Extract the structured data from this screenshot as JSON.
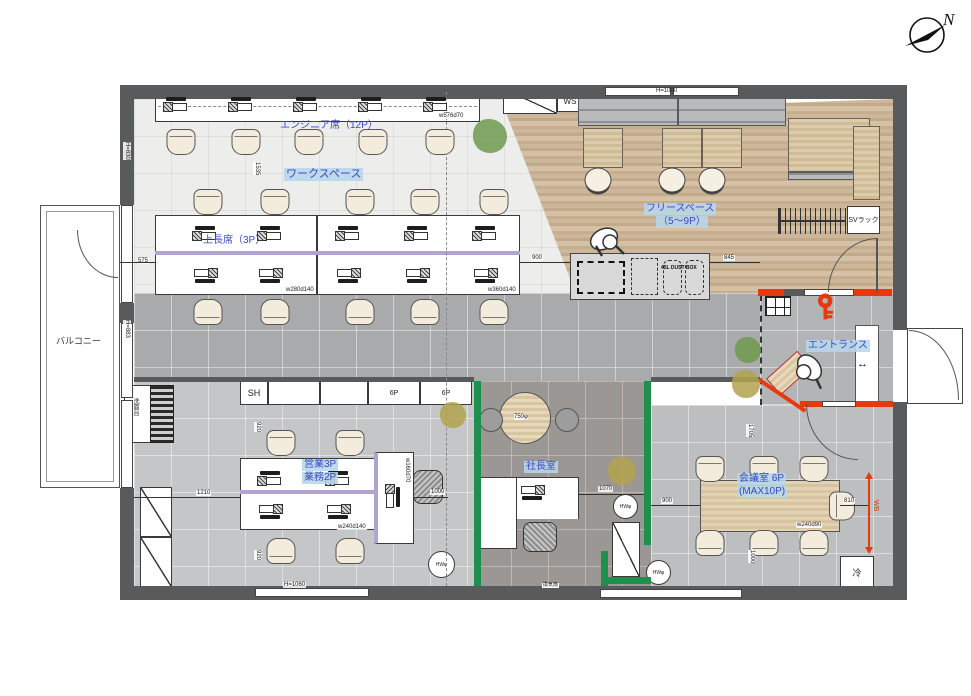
{
  "compass": {
    "north_label": "N"
  },
  "areas": {
    "balcony": "バルコニー",
    "workspace": "ワークスペース",
    "engineer_seats": "エンジニア席（12P）",
    "senior_seats": "上長席（3P）",
    "free_space_line1": "フリースペース",
    "free_space_line2": "（5〜9P）",
    "entrance": "エントランス",
    "president_room": "社長室",
    "meeting_room_line1": "会議室 6P",
    "meeting_room_line2": "(MAX10P)",
    "sales_line1": "営業3P",
    "sales_line2": "業務2P"
  },
  "fixtures": {
    "ws_box": "WS",
    "sv_rack": "SVラック",
    "dust_box": "45L DUST BOX",
    "shelf_sh": "SH",
    "cabinet_6p_a": "6P",
    "cabinet_6p_b": "6P",
    "refrigerator": "冷",
    "whiteboard": "WB",
    "vent_fan": "換気扇",
    "washstand": "洗面台",
    "round_table_dia": "750φ",
    "floor_socket_a": "HWφ",
    "floor_socket_b": "HWφ",
    "floor_socket_c": "HWφ",
    "entry_width_arrow": "↔"
  },
  "dimensions": {
    "engineer_desk": "w576d70",
    "island_left": "w280d140",
    "island_right": "w360d140",
    "sales_island": "w240d140",
    "manager_desk": "w160d70",
    "meeting_table": "w240d90",
    "v1535": "1535",
    "v575": "575",
    "v900_kitchen": "900",
    "v845": "845",
    "v1210": "1210",
    "v920_top": "920",
    "v920_bottom": "920",
    "v1000_sales": "1000",
    "v1070": "1070",
    "v900_meeting": "900",
    "v810": "810",
    "v1705": "1705",
    "v1000_meeting": "1000",
    "h830": "H=830",
    "h883": "H=883",
    "h1060": "H=1060",
    "h1000": "H=1000"
  },
  "colors": {
    "wall": "#595a5c",
    "accent_red": "#e8380d",
    "wall_green": "#1f8f4d",
    "divider_purple": "#b2a4cf",
    "label_blue": "#3b49c4",
    "label_highlight": "#b7d6eb",
    "wood_floor": "#c8b197"
  }
}
